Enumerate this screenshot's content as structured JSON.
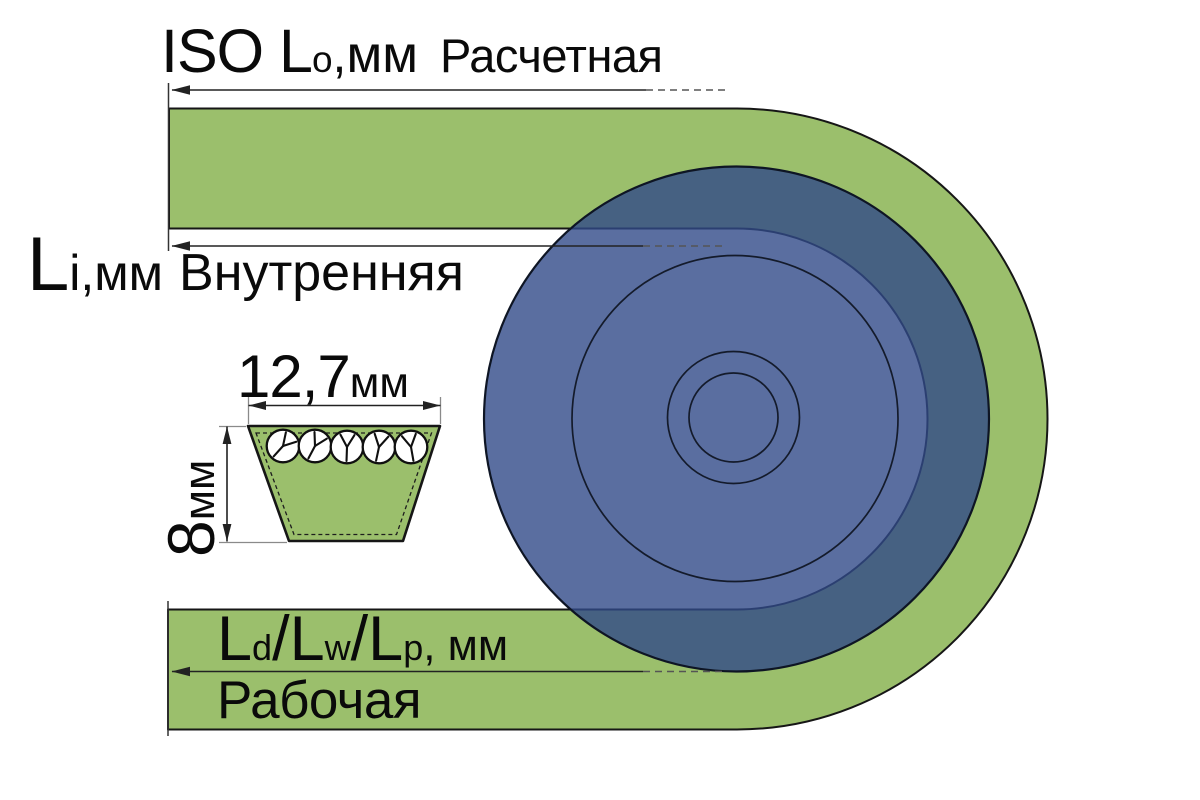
{
  "labels": {
    "outer": {
      "prefix": "ISO L",
      "sub": "o",
      "comma": ",",
      "unit": "мм",
      "title": "Расчетная"
    },
    "inner": {
      "prefix": "L",
      "sub": "i",
      "comma": ",",
      "unit": "мм",
      "title": "Внутренняя"
    },
    "width": {
      "value": "12,7",
      "unit": "мм"
    },
    "height": {
      "value": "8",
      "unit": "мм"
    },
    "pitch": {
      "l1": "L",
      "s1": "d",
      "sep1": "/",
      "l2": "L",
      "s2": "w",
      "sep2": "/",
      "l3": "L",
      "s3": "p",
      "tail": ", мм",
      "title": "Рабочая"
    }
  },
  "colors": {
    "belt_green": "#9bbf6c",
    "pulley_blue": "#314a88",
    "outline_black": "#161616",
    "dimension_line": "#222222",
    "extension_tick": "#8a8a8a",
    "background": "#ffffff",
    "cord_fill": "#ffffff"
  }
}
